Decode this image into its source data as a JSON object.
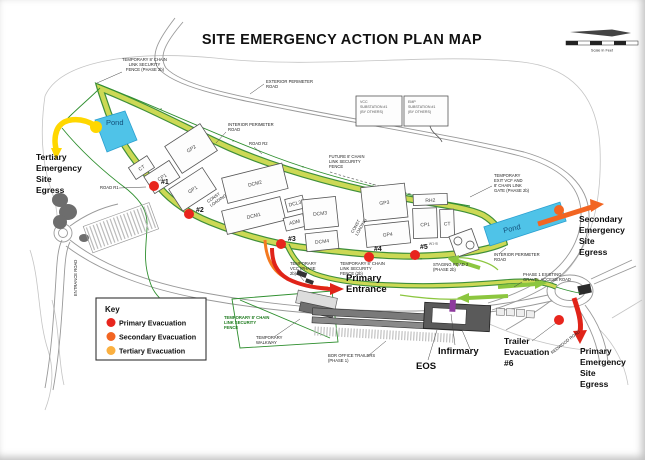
{
  "title": "SITE EMERGENCY ACTION PLAN MAP",
  "scale_bar": {
    "caption": "Scale in Feet"
  },
  "key": {
    "title": "Key",
    "items": [
      {
        "label": "Primary Evacuation",
        "color": "#e8251d"
      },
      {
        "label": "Secondary Evacuation",
        "color": "#f26522"
      },
      {
        "label": "Tertiary Evacuation",
        "color": "#fbb040"
      }
    ]
  },
  "major_labels": {
    "tertiary_egress": {
      "lines": [
        "Tertiary",
        "Emergency",
        "Site",
        "Egress"
      ]
    },
    "secondary_egress": {
      "lines": [
        "Secondary",
        "Emergency",
        "Site",
        "Egress"
      ]
    },
    "primary_egress": {
      "lines": [
        "Primary",
        "Emergency",
        "Site",
        "Egress"
      ]
    },
    "primary_entrance": {
      "lines": [
        "Primary",
        "Entrance"
      ]
    },
    "trailer_evacuation": {
      "lines": [
        "Trailer",
        "Evacuation",
        "#6"
      ]
    },
    "infirmary": "Infirmary",
    "eos": "EOS",
    "pond_left": "Pond",
    "pond_right": "Pond"
  },
  "evacuation_points": [
    "#1",
    "#2",
    "#3",
    "#4",
    "#5"
  ],
  "buildings": {
    "ct_left": "CT",
    "cp1_left": "CP1",
    "gp2": "GP2",
    "gp1": "GP1",
    "dcm2": "DCM2",
    "dcm1": "DCM1",
    "dcl3": "DCL3",
    "adm": "ADM",
    "dcm3": "DCM3",
    "dcm4": "DCM4",
    "gp3": "GP3",
    "gp4": "GP4",
    "rh2": "RH2",
    "cp1_right": "CP1",
    "ct_right": "CT",
    "w1b": "W1-B"
  },
  "annotations": {
    "temp_fence_tl": [
      "TEMPORARY 8' CHAIN",
      "LINK SECURITY",
      "FENCE (PHASE 2b)"
    ],
    "exterior_road": [
      "EXTERIOR PERIMETER",
      "ROAD"
    ],
    "interior_road": [
      "INTERIOR PERIMETER",
      "ROAD"
    ],
    "interior_road_right": [
      "INTERIOR PERIMETER",
      "ROAD"
    ],
    "road_r1": "ROAD R1",
    "road_r2": "ROAD R2",
    "future_fence": [
      "FUTURE 8' CHAIN",
      "LINK SECURITY",
      "FENCE"
    ],
    "temp_exit_gate": [
      "TEMPORARY",
      "EXIT VCF AND",
      "8' CHAIN LINK",
      "GATE (PHASE 2b)"
    ],
    "vcc_substation": [
      "VCC",
      "SUBSTATION #1",
      "(BY OTHERS)"
    ],
    "emp_substation": [
      "EMP",
      "SUBSTATION #1",
      "(BY OTHERS)"
    ],
    "const_loading": [
      "CONST",
      "LOADING"
    ],
    "temp_vcc": [
      "TEMPORARY",
      "VCC (PHASE",
      "2b)"
    ],
    "temp_fence_center": [
      "TEMPORARY 8' CHAIN",
      "LINK SECURITY",
      "FENCE (2b)"
    ],
    "staging_road": [
      "STAGING ROAD 2",
      "(PHASE 2b)"
    ],
    "temp_fence_green": [
      "TEMPORARY 8' CHAIN",
      "LINK SECURITY",
      "FENCE"
    ],
    "temp_walkway": [
      "TEMPORARY",
      "WALKWAY"
    ],
    "bor_trailers": [
      "BOR OFFICE TRAILERS",
      "(PHASE 1)"
    ],
    "gravel_road": [
      "PHASE 1 EXISTING",
      "GRAVEL ACCESS ROAD"
    ],
    "entrance_road": "ENTRANCE ROAD",
    "redwood_road": "REDWOOD ROAD"
  }
}
